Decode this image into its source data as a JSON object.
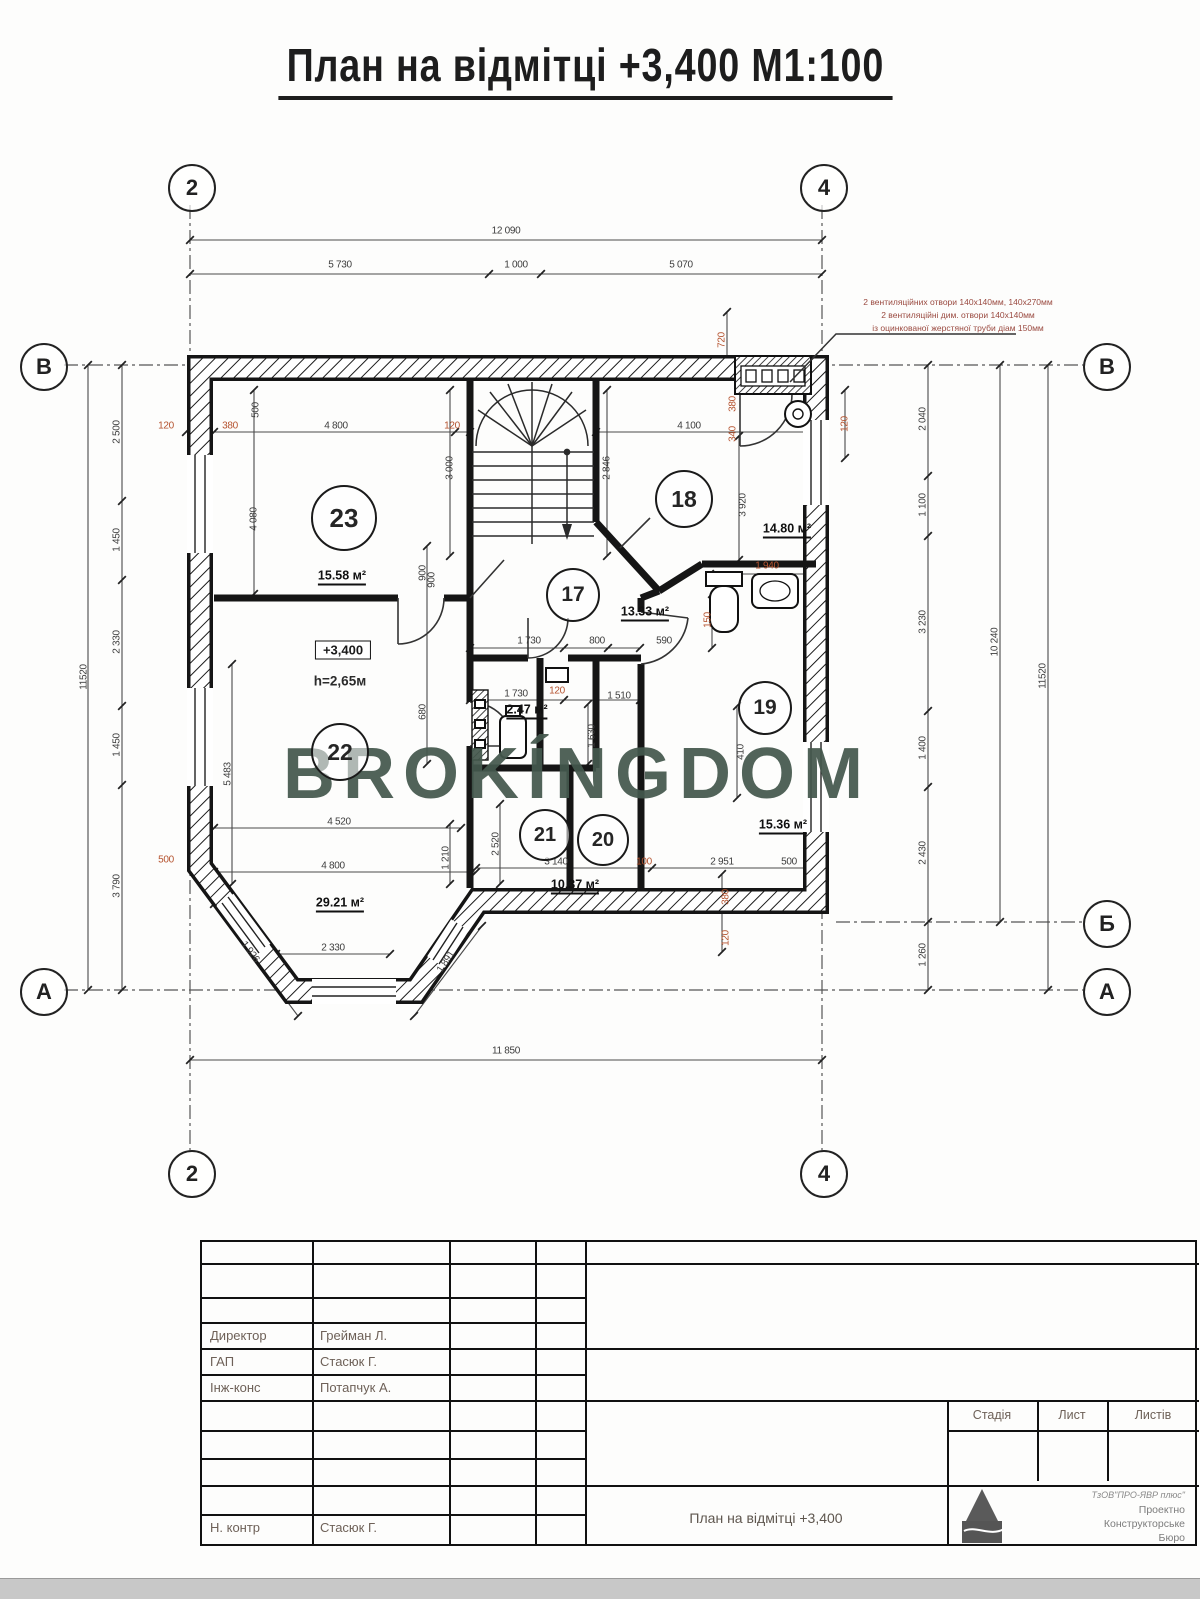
{
  "title": "План на відмітці +3,400   М1:100",
  "watermark": "BROKÍNGDOM",
  "annotation": {
    "lines": [
      "2 вентиляційних отвори 140х140мм, 140х270мм",
      "2 вентиляційні дим. отвори 140х140мм",
      "із оцинкованої жерстяної труби діам 150мм"
    ]
  },
  "elevation": {
    "value": "+3,400",
    "height": "h=2,65м"
  },
  "axis_markers": [
    {
      "label": "2",
      "x": 190,
      "y": 186
    },
    {
      "label": "4",
      "x": 822,
      "y": 186
    },
    {
      "label": "2",
      "x": 190,
      "y": 1172
    },
    {
      "label": "4",
      "x": 822,
      "y": 1172
    },
    {
      "label": "В",
      "x": 42,
      "y": 365
    },
    {
      "label": "А",
      "x": 42,
      "y": 990
    },
    {
      "label": "В",
      "x": 1105,
      "y": 365
    },
    {
      "label": "Б",
      "x": 1105,
      "y": 922
    },
    {
      "label": "А",
      "x": 1105,
      "y": 990
    }
  ],
  "rooms": [
    {
      "num": "23",
      "cx": 342,
      "cy": 516,
      "r": 31,
      "area": "15.58 м²",
      "ax": 342,
      "ay": 577
    },
    {
      "num": "18",
      "cx": 682,
      "cy": 497,
      "r": 27,
      "area": "14.80 м²",
      "ax": 787,
      "ay": 530
    },
    {
      "num": "17",
      "cx": 571,
      "cy": 593,
      "r": 25,
      "area": "13.33 м²",
      "ax": 645,
      "ay": 613
    },
    {
      "num": "19",
      "cx": 763,
      "cy": 706,
      "r": 25,
      "area": "15.36 м²",
      "ax": 783,
      "ay": 826
    },
    {
      "num": "22",
      "cx": 338,
      "cy": 750,
      "r": 27,
      "area": "29.21 м²",
      "ax": 340,
      "ay": 904
    },
    {
      "num": "21",
      "cx": 543,
      "cy": 833,
      "r": 24,
      "area": ""
    },
    {
      "num": "20",
      "cx": 601,
      "cy": 838,
      "r": 24,
      "area": "10.37 м²",
      "ax": 575,
      "ay": 886
    },
    {
      "num": "",
      "cx": 0,
      "cy": 0,
      "r": 0,
      "area": "2.47 м²",
      "ax": 527,
      "ay": 711
    }
  ],
  "dims": [
    {
      "t": "12 090",
      "x": 506,
      "y": 231
    },
    {
      "t": "5 730",
      "x": 340,
      "y": 265
    },
    {
      "t": "1 000",
      "x": 516,
      "y": 265
    },
    {
      "t": "5 070",
      "x": 681,
      "y": 265
    },
    {
      "t": "11 850",
      "x": 506,
      "y": 1051
    },
    {
      "t": "11520",
      "x": 84,
      "y": 677,
      "r": -90
    },
    {
      "t": "2 500",
      "x": 117,
      "y": 432,
      "r": -90
    },
    {
      "t": "1 450",
      "x": 117,
      "y": 540,
      "r": -90
    },
    {
      "t": "2 330",
      "x": 117,
      "y": 642,
      "r": -90
    },
    {
      "t": "1 450",
      "x": 117,
      "y": 745,
      "r": -90
    },
    {
      "t": "3 790",
      "x": 117,
      "y": 886,
      "r": -90
    },
    {
      "t": "2 040",
      "x": 923,
      "y": 419,
      "r": -90
    },
    {
      "t": "1 100",
      "x": 923,
      "y": 505,
      "r": -90
    },
    {
      "t": "3 230",
      "x": 923,
      "y": 622,
      "r": -90
    },
    {
      "t": "1 400",
      "x": 923,
      "y": 748,
      "r": -90
    },
    {
      "t": "2 430",
      "x": 923,
      "y": 853,
      "r": -90
    },
    {
      "t": "1 260",
      "x": 923,
      "y": 955,
      "r": -90
    },
    {
      "t": "10 240",
      "x": 995,
      "y": 642,
      "r": -90
    },
    {
      "t": "11520",
      "x": 1043,
      "y": 676,
      "r": -90
    },
    {
      "t": "120",
      "x": 166,
      "y": 426,
      "c": "r"
    },
    {
      "t": "380",
      "x": 230,
      "y": 426,
      "c": "r"
    },
    {
      "t": "4 800",
      "x": 336,
      "y": 426
    },
    {
      "t": "120",
      "x": 452,
      "y": 426,
      "c": "r"
    },
    {
      "t": "500",
      "x": 256,
      "y": 410,
      "r": -90
    },
    {
      "t": "4 080",
      "x": 254,
      "y": 519,
      "r": -90
    },
    {
      "t": "3 000",
      "x": 450,
      "y": 468,
      "r": -90
    },
    {
      "t": "900",
      "x": 432,
      "y": 580,
      "r": -90
    },
    {
      "t": "2 846",
      "x": 607,
      "y": 468,
      "r": -90
    },
    {
      "t": "4 100",
      "x": 689,
      "y": 426
    },
    {
      "t": "720",
      "x": 722,
      "y": 340,
      "r": -90,
      "c": "r"
    },
    {
      "t": "380",
      "x": 733,
      "y": 404,
      "r": -90,
      "c": "r"
    },
    {
      "t": "340",
      "x": 733,
      "y": 434,
      "r": -90,
      "c": "r"
    },
    {
      "t": "3 920",
      "x": 743,
      "y": 505,
      "r": -90
    },
    {
      "t": "1 940",
      "x": 767,
      "y": 566,
      "c": "r"
    },
    {
      "t": "150",
      "x": 708,
      "y": 620,
      "r": -90,
      "c": "r"
    },
    {
      "t": "1 730",
      "x": 529,
      "y": 641
    },
    {
      "t": "800",
      "x": 597,
      "y": 641
    },
    {
      "t": "590",
      "x": 664,
      "y": 641
    },
    {
      "t": "1 730",
      "x": 516,
      "y": 694
    },
    {
      "t": "120",
      "x": 557,
      "y": 691,
      "c": "r"
    },
    {
      "t": "1 510",
      "x": 619,
      "y": 696
    },
    {
      "t": "1 630",
      "x": 592,
      "y": 736,
      "r": -90
    },
    {
      "t": "900",
      "x": 423,
      "y": 573,
      "r": -90
    },
    {
      "t": "680",
      "x": 423,
      "y": 712,
      "r": -90
    },
    {
      "t": "5 483",
      "x": 228,
      "y": 774,
      "r": -90
    },
    {
      "t": "4 520",
      "x": 339,
      "y": 822
    },
    {
      "t": "4 800",
      "x": 333,
      "y": 866
    },
    {
      "t": "1 210",
      "x": 446,
      "y": 858,
      "r": -90
    },
    {
      "t": "2 520",
      "x": 496,
      "y": 844,
      "r": -90
    },
    {
      "t": "3 140",
      "x": 556,
      "y": 862
    },
    {
      "t": "100",
      "x": 644,
      "y": 862,
      "c": "r"
    },
    {
      "t": "2 951",
      "x": 722,
      "y": 862
    },
    {
      "t": "500",
      "x": 789,
      "y": 862
    },
    {
      "t": "1 926",
      "x": 250,
      "y": 952,
      "r": 53
    },
    {
      "t": "1 891",
      "x": 446,
      "y": 962,
      "r": -56
    },
    {
      "t": "2 330",
      "x": 333,
      "y": 948
    },
    {
      "t": "500",
      "x": 166,
      "y": 860,
      "c": "r"
    },
    {
      "t": "380",
      "x": 726,
      "y": 897,
      "r": -90,
      "c": "r"
    },
    {
      "t": "120",
      "x": 726,
      "y": 938,
      "r": -90,
      "c": "r"
    },
    {
      "t": "410",
      "x": 741,
      "y": 752,
      "r": -90
    },
    {
      "t": "120",
      "x": 845,
      "y": 424,
      "r": -90,
      "c": "r"
    }
  ],
  "title_block": {
    "rows": [
      {
        "role": "Директор",
        "name": "Грейман Л."
      },
      {
        "role": "ГАП",
        "name": "Стасюк Г."
      },
      {
        "role": "Інж-конс",
        "name": "Потапчук А."
      },
      {
        "role": "Н. контр",
        "name": "Стасюк Г."
      }
    ],
    "drawing_title": "План на відмітці  +3,400",
    "columns": [
      "Стадія",
      "Лист",
      "Листів"
    ],
    "company": [
      "ТзОВ\"ПРО-ЯВР плюс\"",
      "Проектно",
      "Конструкторське",
      "Бюро"
    ]
  },
  "colors": {
    "watermark": "#44584d",
    "dim_red": "#b5532f",
    "annotation": "#9a4a40",
    "wall": "#151515"
  }
}
